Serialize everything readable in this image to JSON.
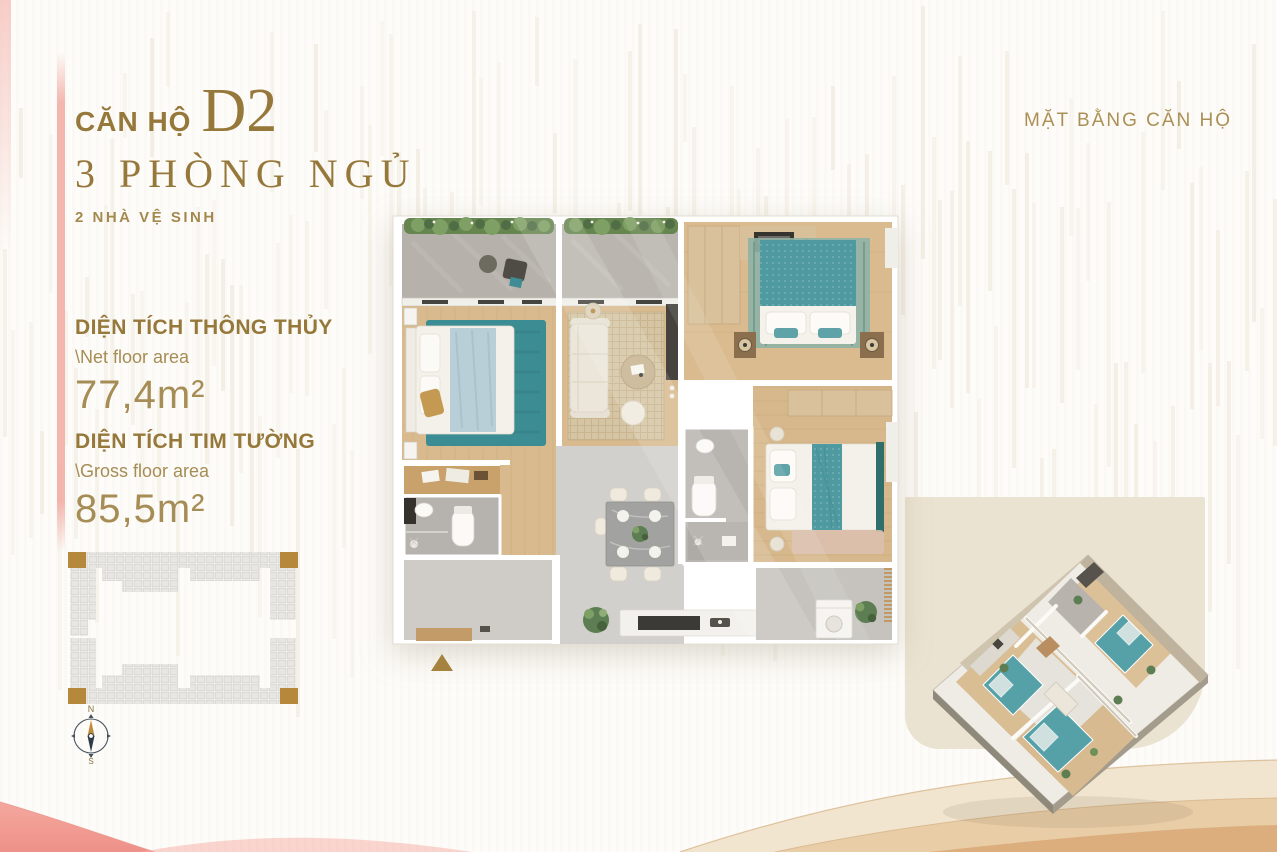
{
  "header": {
    "unit_label": "CĂN HỘ",
    "unit_code": "D2",
    "bedrooms_line": "3 PHÒNG NGỦ",
    "bathrooms_line": "2 NHÀ VỆ SINH",
    "plan_caption": "MẶT BẰNG CĂN HỘ"
  },
  "areas": {
    "net": {
      "title": "DIỆN TÍCH THÔNG THỦY",
      "subtitle": "\\Net floor area",
      "value": "77,4m²"
    },
    "gross": {
      "title": "DIỆN TÍCH TIM TƯỜNG",
      "subtitle": "\\Gross floor area",
      "value": "85,5m²"
    }
  },
  "compass": {
    "north_label": "N",
    "south_label": "S"
  },
  "colors": {
    "gold": "#96783a",
    "gold-light": "#ab9055",
    "pink": "#f09a92",
    "beige-block": "#ebe3d1",
    "teal": "#4f9aa1",
    "tan": "#e6c9a2"
  }
}
